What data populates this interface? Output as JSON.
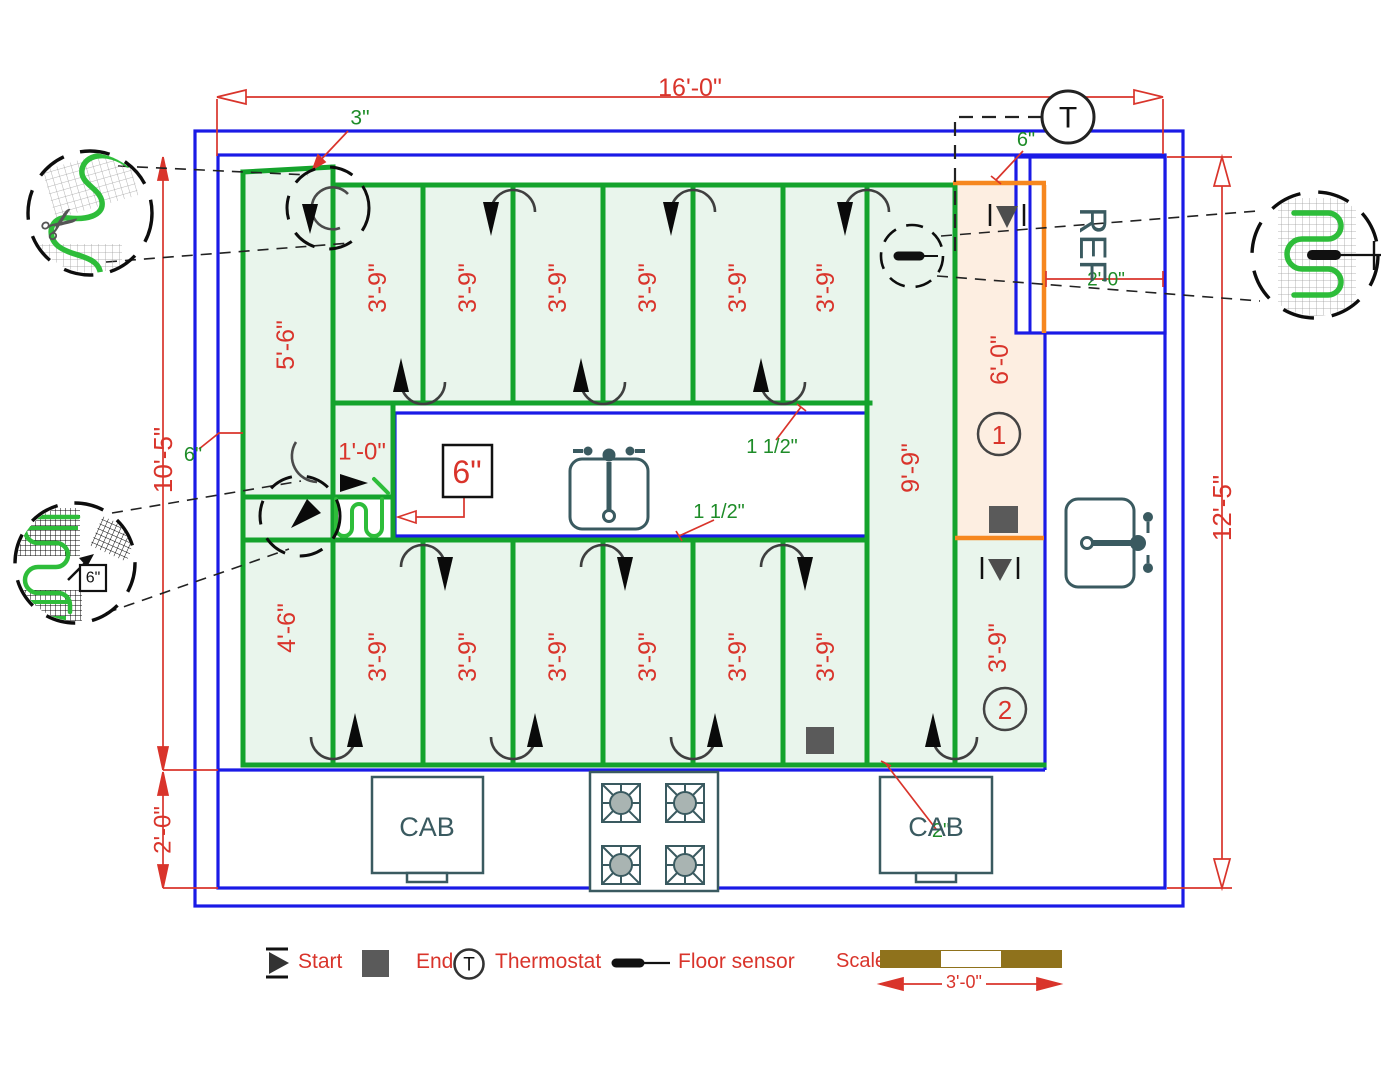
{
  "drawing": {
    "title_hint": "Kitchen floor heating mat layout plan",
    "colors": {
      "wall_blue": "#1a1ae6",
      "mat_green": "#14a32c",
      "mat_fill": "#e9f5ec",
      "dim_red": "#d9342b",
      "label_green": "#1e8c28",
      "fixture_slate": "#3a5a60",
      "counter_peach": "#fdeee1",
      "orange": "#f6871f",
      "scale_brown": "#8f721c",
      "cable_green": "#2ebd3a",
      "end_gray": "#5a5a5a"
    },
    "legend": {
      "start": "Start",
      "end": "End",
      "thermostat": "Thermostat",
      "floor_sensor": "Floor sensor",
      "scale_label": "Scale",
      "scale_value": "3'-0\""
    },
    "labels": [
      {
        "x": 690,
        "y": 88,
        "t": "16'-0\"",
        "r": 0,
        "c": "red",
        "s": 25,
        "n": "dim-total-width"
      },
      {
        "x": 1222,
        "y": 508,
        "t": "12'-5\"",
        "r": -90,
        "c": "red",
        "s": 26,
        "n": "dim-total-height"
      },
      {
        "x": 163,
        "y": 460,
        "t": "10'-5\"",
        "r": -90,
        "c": "red",
        "s": 26,
        "n": "dim-left-height"
      },
      {
        "x": 163,
        "y": 830,
        "t": "2'-0\"",
        "r": -90,
        "c": "red",
        "s": 24,
        "n": "dim-counter-depth"
      },
      {
        "x": 286,
        "y": 345,
        "t": "5'-6\"",
        "r": -90,
        "c": "red",
        "s": 25,
        "n": "mat-run-label"
      },
      {
        "x": 378,
        "y": 288,
        "t": "3'-9\"",
        "r": -90,
        "c": "red",
        "s": 25,
        "n": "mat-run-label"
      },
      {
        "x": 468,
        "y": 288,
        "t": "3'-9\"",
        "r": -90,
        "c": "red",
        "s": 25,
        "n": "mat-run-label"
      },
      {
        "x": 558,
        "y": 288,
        "t": "3'-9\"",
        "r": -90,
        "c": "red",
        "s": 25,
        "n": "mat-run-label"
      },
      {
        "x": 648,
        "y": 288,
        "t": "3'-9\"",
        "r": -90,
        "c": "red",
        "s": 25,
        "n": "mat-run-label"
      },
      {
        "x": 738,
        "y": 288,
        "t": "3'-9\"",
        "r": -90,
        "c": "red",
        "s": 25,
        "n": "mat-run-label"
      },
      {
        "x": 826,
        "y": 288,
        "t": "3'-9\"",
        "r": -90,
        "c": "red",
        "s": 25,
        "n": "mat-run-label"
      },
      {
        "x": 911,
        "y": 468,
        "t": "9'-9\"",
        "r": -90,
        "c": "red",
        "s": 25,
        "n": "mat-run-label"
      },
      {
        "x": 1000,
        "y": 360,
        "t": "6'-0\"",
        "r": -90,
        "c": "red",
        "s": 25,
        "n": "mat-run-label"
      },
      {
        "x": 362,
        "y": 452,
        "t": "1'-0\"",
        "r": 0,
        "c": "red",
        "s": 24,
        "n": "mat-run-label"
      },
      {
        "x": 287,
        "y": 628,
        "t": "4'-6\"",
        "r": -90,
        "c": "red",
        "s": 25,
        "n": "mat-run-label"
      },
      {
        "x": 378,
        "y": 657,
        "t": "3'-9\"",
        "r": -90,
        "c": "red",
        "s": 25,
        "n": "mat-run-label"
      },
      {
        "x": 468,
        "y": 657,
        "t": "3'-9\"",
        "r": -90,
        "c": "red",
        "s": 25,
        "n": "mat-run-label"
      },
      {
        "x": 558,
        "y": 657,
        "t": "3'-9\"",
        "r": -90,
        "c": "red",
        "s": 25,
        "n": "mat-run-label"
      },
      {
        "x": 648,
        "y": 657,
        "t": "3'-9\"",
        "r": -90,
        "c": "red",
        "s": 25,
        "n": "mat-run-label"
      },
      {
        "x": 738,
        "y": 657,
        "t": "3'-9\"",
        "r": -90,
        "c": "red",
        "s": 25,
        "n": "mat-run-label"
      },
      {
        "x": 826,
        "y": 657,
        "t": "3'-9\"",
        "r": -90,
        "c": "red",
        "s": 25,
        "n": "mat-run-label"
      },
      {
        "x": 998,
        "y": 648,
        "t": "3'-9\"",
        "r": -90,
        "c": "red",
        "s": 25,
        "n": "mat-run-label"
      },
      {
        "x": 467,
        "y": 472,
        "t": "6\"",
        "r": 0,
        "c": "red",
        "s": 32,
        "n": "mat-spacing-callout"
      },
      {
        "x": 999,
        "y": 435,
        "t": "1",
        "r": 0,
        "c": "red",
        "s": 26,
        "n": "mat-number-1"
      },
      {
        "x": 1005,
        "y": 710,
        "t": "2",
        "r": 0,
        "c": "red",
        "s": 26,
        "n": "mat-number-2"
      },
      {
        "x": 360,
        "y": 118,
        "t": "3\"",
        "r": 0,
        "c": "green",
        "s": 21,
        "n": "gap-note"
      },
      {
        "x": 193,
        "y": 455,
        "t": "6\"",
        "r": 0,
        "c": "green",
        "s": 20,
        "n": "gap-note"
      },
      {
        "x": 1026,
        "y": 140,
        "t": "6\"",
        "r": 0,
        "c": "green",
        "s": 20,
        "n": "gap-note"
      },
      {
        "x": 1106,
        "y": 280,
        "t": "2'-0\"",
        "r": 0,
        "c": "green",
        "s": 19,
        "n": "ref-depth-note"
      },
      {
        "x": 772,
        "y": 447,
        "t": "1 1/2\"",
        "r": 0,
        "c": "green",
        "s": 20,
        "n": "edge-gap-note"
      },
      {
        "x": 719,
        "y": 512,
        "t": "1 1/2\"",
        "r": 0,
        "c": "green",
        "s": 20,
        "n": "edge-gap-note"
      },
      {
        "x": 941,
        "y": 831,
        "t": "2\"",
        "r": 0,
        "c": "green",
        "s": 20,
        "n": "gap-note"
      },
      {
        "x": 1092,
        "y": 245,
        "t": "REF",
        "r": 90,
        "c": "slate",
        "s": 38,
        "n": "refrigerator-label"
      },
      {
        "x": 427,
        "y": 827,
        "t": "CAB",
        "r": 0,
        "c": "slate",
        "s": 27,
        "n": "cabinet-label"
      },
      {
        "x": 936,
        "y": 827,
        "t": "CAB",
        "r": 0,
        "c": "slate",
        "s": 27,
        "n": "cabinet-label"
      },
      {
        "x": 1068,
        "y": 118,
        "t": "T",
        "r": 0,
        "c": "black",
        "s": 30,
        "n": "thermostat-symbol-letter"
      },
      {
        "x": 93,
        "y": 578,
        "t": "6\"",
        "r": 0,
        "c": "black",
        "s": 16,
        "n": "detail-spacing-label"
      }
    ]
  }
}
